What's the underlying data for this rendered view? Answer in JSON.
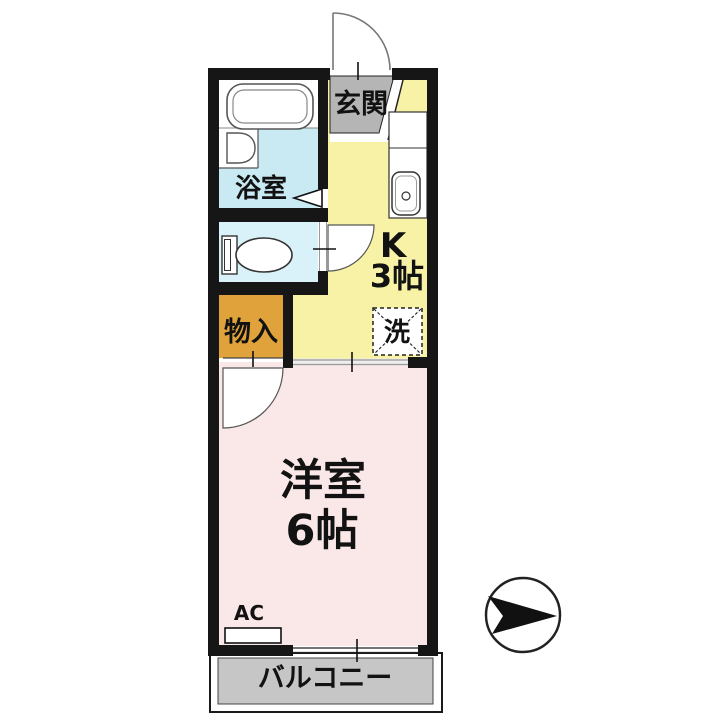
{
  "floor_plan": {
    "rooms": {
      "genkan": {
        "label": "玄関"
      },
      "bathroom": {
        "label": "浴室"
      },
      "kitchen": {
        "label": "K",
        "size": "3帖"
      },
      "laundry": {
        "label": "洗"
      },
      "closet": {
        "label": "物入"
      },
      "western_room": {
        "label": "洋室",
        "size": "6帖"
      },
      "balcony": {
        "label": "バルコニー"
      },
      "ac_unit": {
        "label": "AC"
      }
    },
    "compass": {
      "icon": "north-arrow-icon",
      "direction": "right"
    },
    "colors": {
      "wall": "#161616",
      "kitchen_floor": "#f7f2a6",
      "bathroom_floor": "#c9eaf3",
      "toilet_floor": "#d9f1f8",
      "entrance_floor": "#b5b5b5",
      "closet_floor": "#e0a33c",
      "room_floor": "#f9e8e7",
      "balcony_floor": "#c6c6c6"
    }
  }
}
